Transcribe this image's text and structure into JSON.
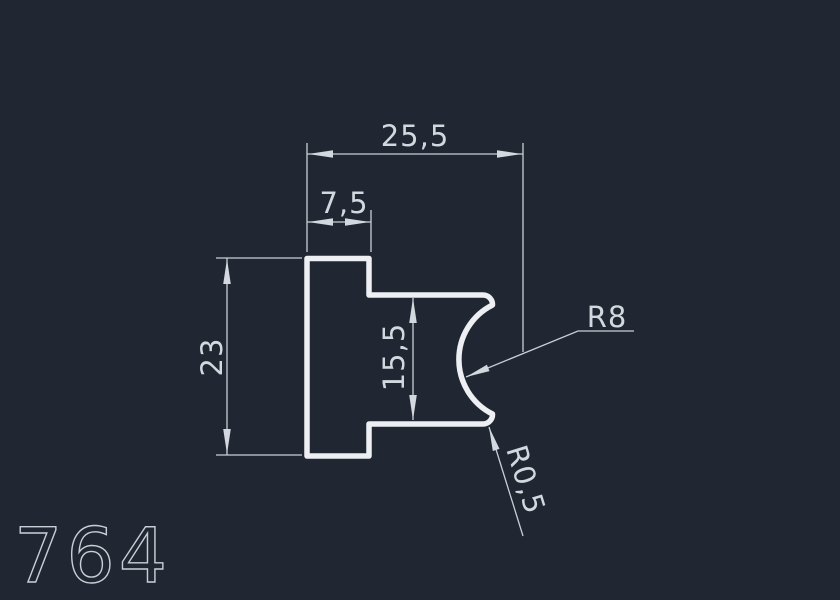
{
  "drawing": {
    "profile_number": "764",
    "dimensions": {
      "total_width": "25,5",
      "tab_width": "7,5",
      "total_height": "23",
      "notch_height": "15,5",
      "large_radius": "R8",
      "small_radius": "R0,5"
    },
    "colors": {
      "background": "#212732",
      "profile_line": "#edeff2",
      "dimension_line": "#c9ced6",
      "text": "#d3d7de"
    }
  }
}
